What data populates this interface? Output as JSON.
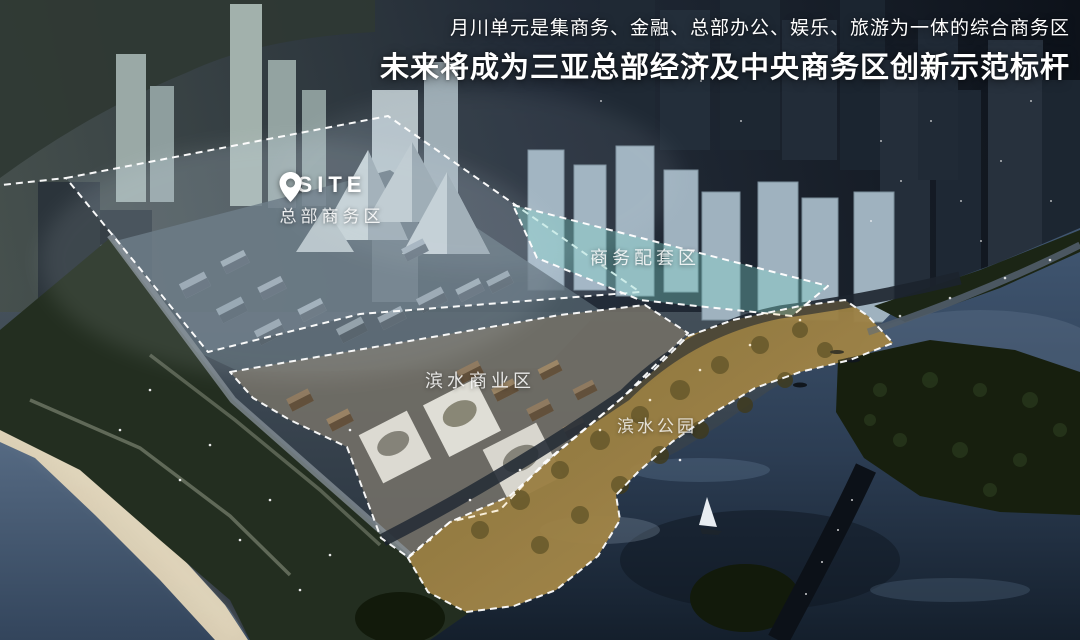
{
  "headline": {
    "line1": "月川单元是集商务、金融、总部办公、娱乐、旅游为一体的综合商务区",
    "line2": "未来将成为三亚总部经济及中央商务区创新示范标杆"
  },
  "site_marker": {
    "title": "SITE",
    "zone_label": "总部商务区"
  },
  "zone_labels": {
    "business_support": "商务配套区",
    "waterfront_commercial": "滨水商业区",
    "waterfront_park": "滨水公园"
  },
  "zones": [
    {
      "id": "headquarters-business",
      "label": "总部商务区"
    },
    {
      "id": "business-support",
      "label": "商务配套区"
    },
    {
      "id": "waterfront-commercial",
      "label": "滨水商业区"
    },
    {
      "id": "waterfront-park",
      "label": "滨水公园"
    }
  ],
  "colors": {
    "headline_text": "#ffffff",
    "zone_outline": "#ffffff",
    "hq_zone_fill": "rgba(195,215,232,0.15)",
    "business_support_fill": "rgba(125,210,200,0.38)",
    "waterfront_park_fill": "rgba(255,205,100,0.20)",
    "river_water": "#33465e",
    "night_city": "#1d2736",
    "park_gold": "#8a7340"
  }
}
